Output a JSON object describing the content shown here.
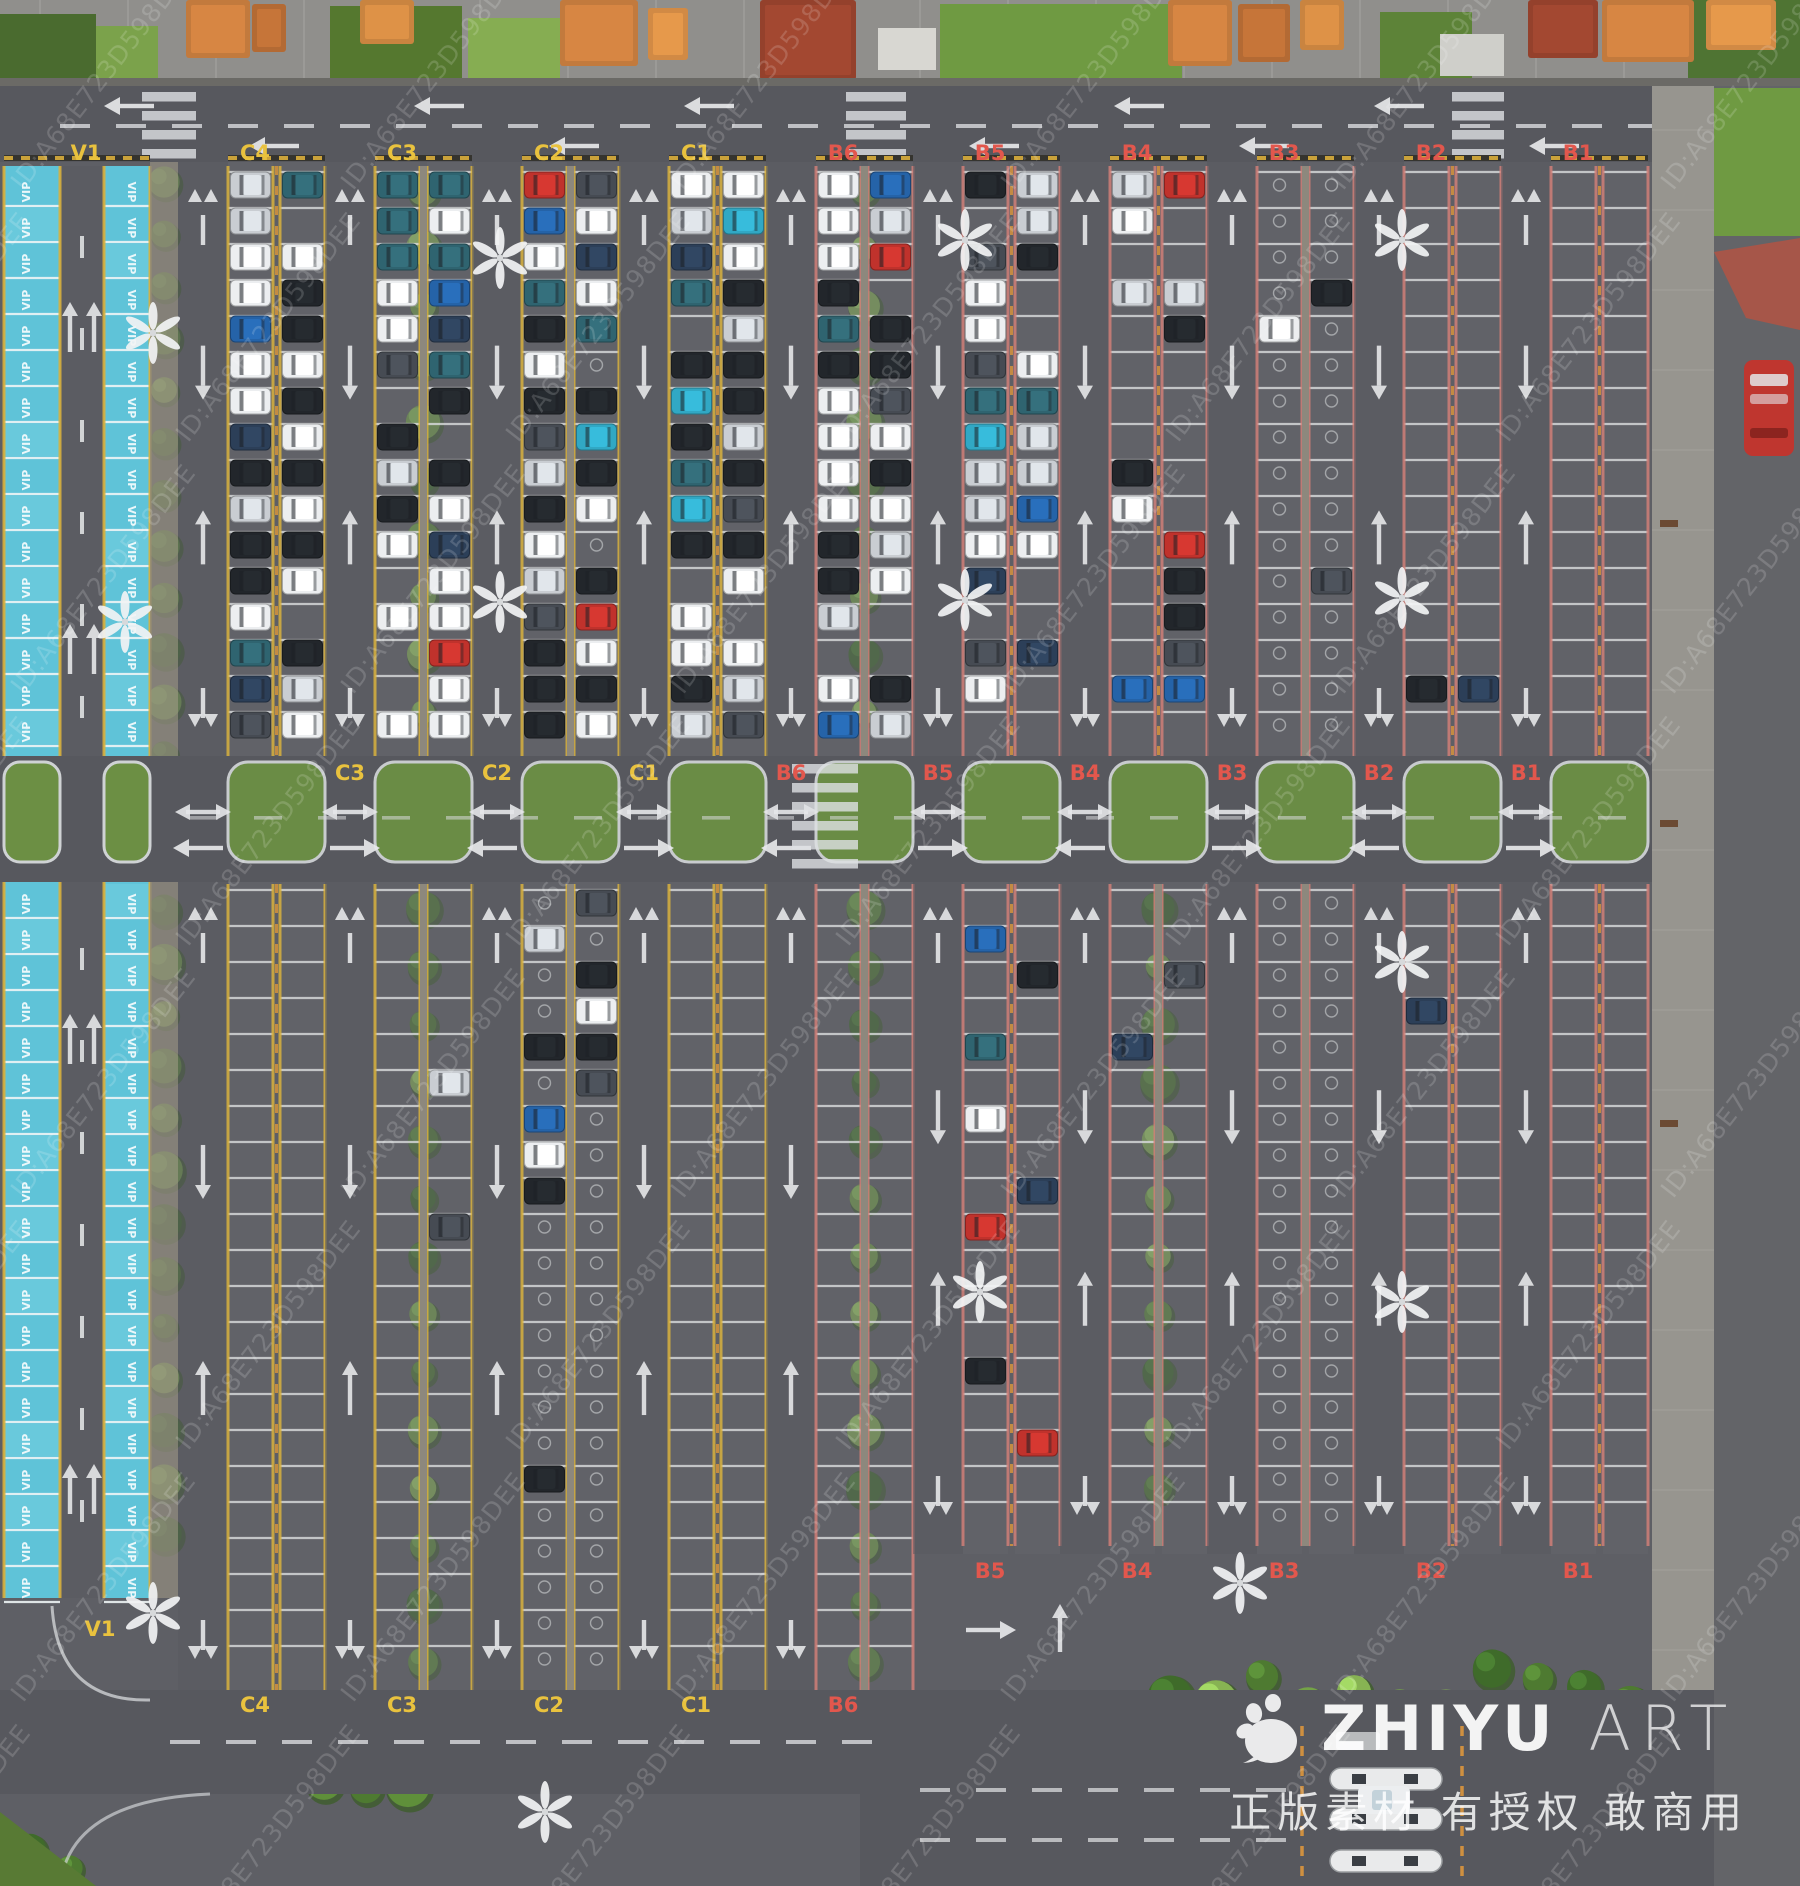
{
  "scene": {
    "type": "aerial drone photograph",
    "subject": "large zoned outdoor parking lot with VIP lane, tree dividers, toll exit plaza",
    "width": 1800,
    "height": 1886
  },
  "watermark": {
    "tile_text": "ID:A68E723D598DEE",
    "brand": "ZHIYU",
    "brand_suffix": "ART",
    "tagline": "正版素材 有授权 敢商用"
  },
  "vip": {
    "zone_label": "V1",
    "stall_text": "VIP"
  },
  "zone_labels": {
    "top": [
      "V1",
      "C4",
      "C3",
      "C2",
      "C1",
      "B6",
      "B5",
      "B4",
      "B3",
      "B2",
      "B1"
    ],
    "middle": [
      "C3",
      "C2",
      "C1",
      "B6",
      "B5",
      "B4",
      "B3",
      "B2",
      "B1"
    ],
    "bottom_b": [
      "B5",
      "B4",
      "B3",
      "B2",
      "B1"
    ],
    "bottom_c": [
      "C4",
      "C3",
      "C2",
      "C1",
      "B6"
    ],
    "bottom_vip": "V1"
  },
  "modules": [
    {
      "id": "C4",
      "family": "C",
      "gap": "dash"
    },
    {
      "id": "C3",
      "family": "C",
      "gap": "trees"
    },
    {
      "id": "C2",
      "family": "C",
      "gap": "walk"
    },
    {
      "id": "C1",
      "family": "C",
      "gap": "dash"
    },
    {
      "id": "B6",
      "family": "B",
      "gap": "trees"
    },
    {
      "id": "B5",
      "family": "B",
      "gap": "dash"
    },
    {
      "id": "B4",
      "family": "B",
      "gap": "dash-trees-bottom"
    },
    {
      "id": "B3",
      "family": "B",
      "gap": "walk"
    },
    {
      "id": "B2",
      "family": "B",
      "gap": "dash"
    },
    {
      "id": "B1",
      "family": "B",
      "gap": "dash"
    }
  ],
  "families": {
    "C": {
      "edge_color": "#d8b13e",
      "label_color": "#e9c23e"
    },
    "B": {
      "edge_color": "#d07f78",
      "label_color": "#e2574d"
    }
  },
  "vip_colors": {
    "stall": "#5fc3d8",
    "stall_light": "#74cfe0",
    "label": "#e9c23e"
  },
  "occupancy": {
    "top": {
      "C4": 0.88,
      "C3": 0.8,
      "C2": 0.86,
      "C1": 0.88,
      "B6": 0.85,
      "B5": 0.78,
      "B4": 0.45,
      "B3": 0.1,
      "B2": 0.08,
      "B1": 0.02
    },
    "bottom": {
      "C4": 0.02,
      "C3": 0.05,
      "C2": 0.3,
      "C1": 0.02,
      "B6": 0.03,
      "B5": 0.1,
      "B4": 0.04,
      "B3": 0.02,
      "B2": 0.01,
      "B1": 0.0
    }
  },
  "car_colors": [
    [
      "#eceef0",
      0.34
    ],
    [
      "#c9cdd2",
      0.1
    ],
    [
      "#22262b",
      0.22
    ],
    [
      "#464b53",
      0.1
    ],
    [
      "#2c3f58",
      0.07
    ],
    [
      "#2f6470",
      0.05
    ],
    [
      "#c0322c",
      0.06
    ],
    [
      "#2563a8",
      0.03
    ],
    [
      "#31a8c4",
      0.03
    ]
  ],
  "palette": {
    "asphalt": "#5e5f65",
    "road": "#57585e",
    "lane": "#595a60",
    "stall_line": "#d9dbdd",
    "walkway": "#8d887d",
    "plaza": "#908f8c",
    "sidewalk": "#97958f",
    "grass": "#6c8f44",
    "curb": "#cfd2d4",
    "orange_dash": "#cf9040",
    "toll_island": "#e9eaeb",
    "bus": "#bf362f",
    "tree_greens": [
      "#4e7a31",
      "#5f8f3a",
      "#74a347",
      "#87b353",
      "#3f6b2a"
    ],
    "container_oranges": [
      "#c27a3d",
      "#b36a34",
      "#c98440",
      "#94412c",
      "#d18a45"
    ]
  }
}
